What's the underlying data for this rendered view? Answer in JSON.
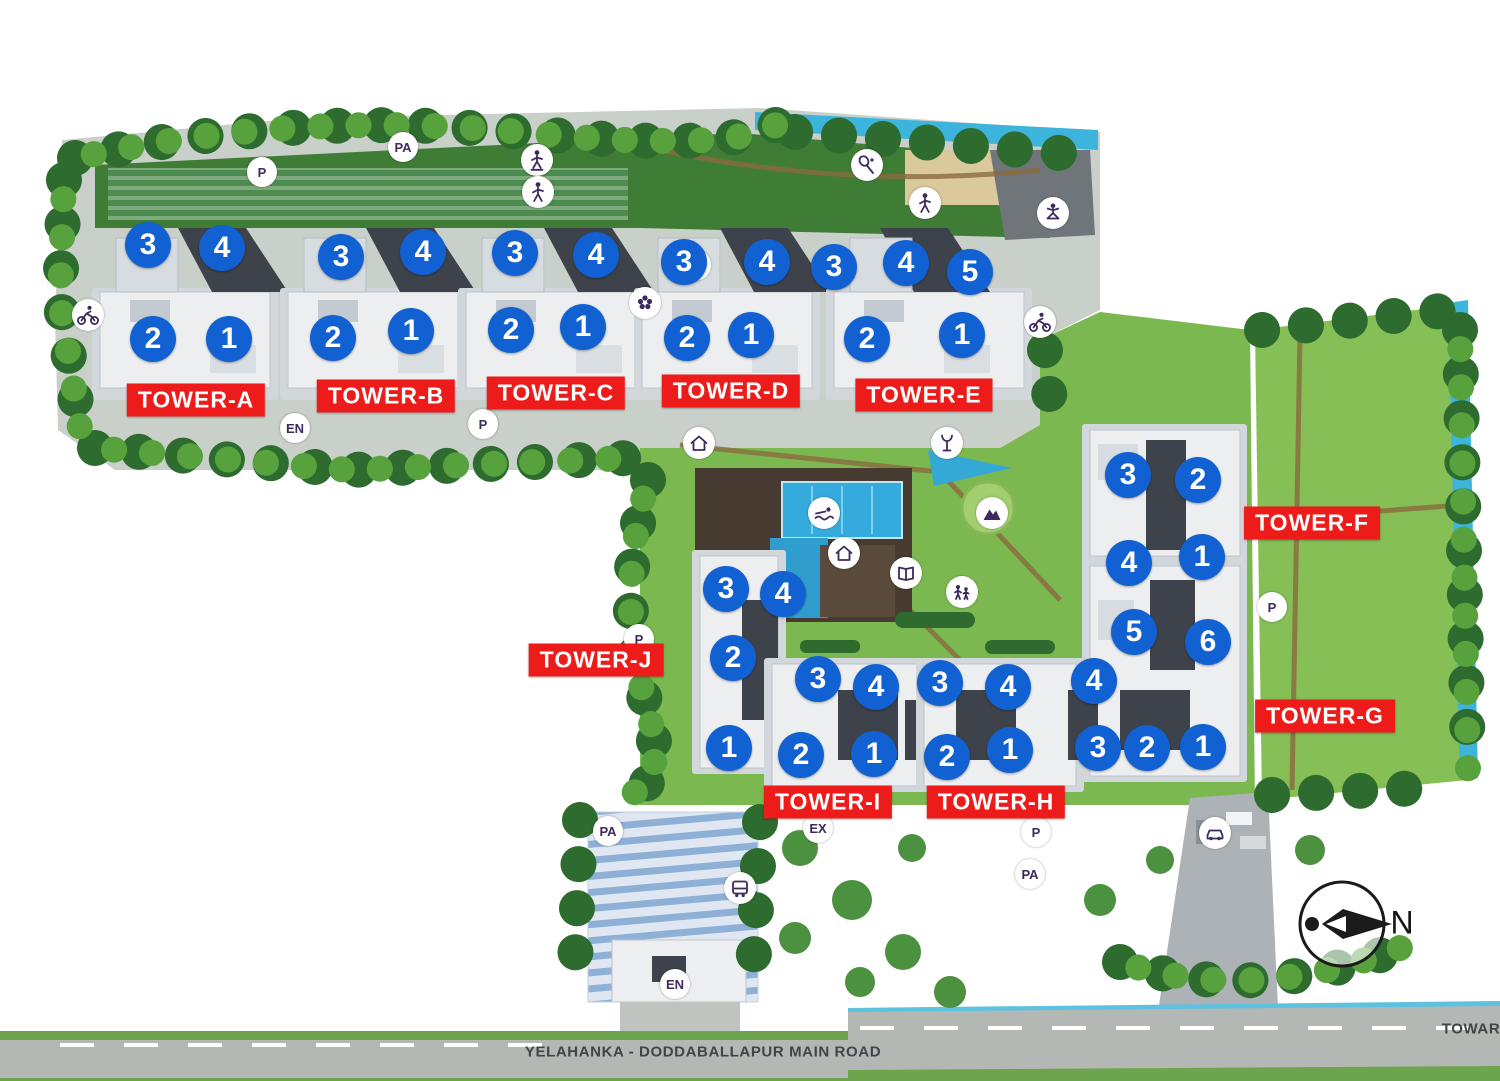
{
  "towers": [
    {
      "id": "A",
      "label": "TOWER-A",
      "label_pos": {
        "x": 196,
        "y": 400
      },
      "units": [
        {
          "n": "3",
          "x": 148,
          "y": 245
        },
        {
          "n": "4",
          "x": 222,
          "y": 248
        },
        {
          "n": "2",
          "x": 153,
          "y": 339
        },
        {
          "n": "1",
          "x": 229,
          "y": 339
        }
      ]
    },
    {
      "id": "B",
      "label": "TOWER-B",
      "label_pos": {
        "x": 386,
        "y": 396
      },
      "units": [
        {
          "n": "3",
          "x": 341,
          "y": 257
        },
        {
          "n": "4",
          "x": 423,
          "y": 252
        },
        {
          "n": "2",
          "x": 333,
          "y": 338
        },
        {
          "n": "1",
          "x": 411,
          "y": 331
        }
      ]
    },
    {
      "id": "C",
      "label": "TOWER-C",
      "label_pos": {
        "x": 556,
        "y": 393
      },
      "units": [
        {
          "n": "3",
          "x": 515,
          "y": 253
        },
        {
          "n": "4",
          "x": 596,
          "y": 255
        },
        {
          "n": "2",
          "x": 511,
          "y": 330
        },
        {
          "n": "1",
          "x": 583,
          "y": 327
        }
      ]
    },
    {
      "id": "D",
      "label": "TOWER-D",
      "label_pos": {
        "x": 731,
        "y": 391
      },
      "units": [
        {
          "n": "3",
          "x": 684,
          "y": 262
        },
        {
          "n": "4",
          "x": 767,
          "y": 262
        },
        {
          "n": "2",
          "x": 687,
          "y": 338
        },
        {
          "n": "1",
          "x": 751,
          "y": 335
        }
      ]
    },
    {
      "id": "E",
      "label": "TOWER-E",
      "label_pos": {
        "x": 924,
        "y": 395
      },
      "units": [
        {
          "n": "3",
          "x": 834,
          "y": 267
        },
        {
          "n": "4",
          "x": 906,
          "y": 263
        },
        {
          "n": "5",
          "x": 970,
          "y": 272
        },
        {
          "n": "2",
          "x": 867,
          "y": 339
        },
        {
          "n": "1",
          "x": 962,
          "y": 335
        }
      ]
    },
    {
      "id": "F",
      "label": "TOWER-F",
      "label_pos": {
        "x": 1312,
        "y": 523
      },
      "units": [
        {
          "n": "3",
          "x": 1128,
          "y": 475
        },
        {
          "n": "2",
          "x": 1198,
          "y": 480
        },
        {
          "n": "4",
          "x": 1129,
          "y": 563
        },
        {
          "n": "1",
          "x": 1202,
          "y": 557
        }
      ]
    },
    {
      "id": "G",
      "label": "TOWER-G",
      "label_pos": {
        "x": 1325,
        "y": 716
      },
      "units": [
        {
          "n": "5",
          "x": 1134,
          "y": 632
        },
        {
          "n": "6",
          "x": 1208,
          "y": 642
        },
        {
          "n": "4",
          "x": 1094,
          "y": 681
        },
        {
          "n": "3",
          "x": 1098,
          "y": 748
        },
        {
          "n": "2",
          "x": 1147,
          "y": 748
        },
        {
          "n": "1",
          "x": 1203,
          "y": 747
        }
      ]
    },
    {
      "id": "H",
      "label": "TOWER-H",
      "label_pos": {
        "x": 996,
        "y": 802
      },
      "units": [
        {
          "n": "3",
          "x": 940,
          "y": 683
        },
        {
          "n": "4",
          "x": 1008,
          "y": 687
        },
        {
          "n": "2",
          "x": 947,
          "y": 757
        },
        {
          "n": "1",
          "x": 1010,
          "y": 750
        }
      ]
    },
    {
      "id": "I",
      "label": "TOWER-I",
      "label_pos": {
        "x": 828,
        "y": 802
      },
      "units": [
        {
          "n": "3",
          "x": 818,
          "y": 679
        },
        {
          "n": "4",
          "x": 876,
          "y": 687
        },
        {
          "n": "2",
          "x": 801,
          "y": 755
        },
        {
          "n": "1",
          "x": 874,
          "y": 754
        }
      ]
    },
    {
      "id": "J",
      "label": "TOWER-J",
      "label_pos": {
        "x": 596,
        "y": 660
      },
      "units": [
        {
          "n": "3",
          "x": 726,
          "y": 589
        },
        {
          "n": "4",
          "x": 783,
          "y": 594
        },
        {
          "n": "2",
          "x": 733,
          "y": 658
        },
        {
          "n": "1",
          "x": 729,
          "y": 748
        }
      ]
    }
  ],
  "site_markers": [
    {
      "label": "P",
      "x": 262,
      "y": 172
    },
    {
      "label": "PA",
      "x": 403,
      "y": 147
    },
    {
      "label": "EN",
      "x": 295,
      "y": 428
    },
    {
      "label": "P",
      "x": 483,
      "y": 424
    },
    {
      "label": "P",
      "x": 639,
      "y": 639
    },
    {
      "label": "PA",
      "x": 608,
      "y": 831
    },
    {
      "label": "EX",
      "x": 818,
      "y": 828
    },
    {
      "label": "EN",
      "x": 675,
      "y": 984
    },
    {
      "label": "P",
      "x": 1036,
      "y": 832
    },
    {
      "label": "PA",
      "x": 1030,
      "y": 874
    },
    {
      "label": "P",
      "x": 1272,
      "y": 607
    }
  ],
  "amenity_icons": [
    {
      "name": "cyclist-icon",
      "x": 88,
      "y": 315
    },
    {
      "name": "skating-icon",
      "x": 537,
      "y": 160
    },
    {
      "name": "exercise-icon",
      "x": 538,
      "y": 192
    },
    {
      "name": "walking-icon",
      "x": 695,
      "y": 265
    },
    {
      "name": "spa-flower-icon",
      "x": 645,
      "y": 303
    },
    {
      "name": "racquet-court-icon",
      "x": 867,
      "y": 165
    },
    {
      "name": "jogging-icon",
      "x": 925,
      "y": 203
    },
    {
      "name": "yoga-icon",
      "x": 1053,
      "y": 213
    },
    {
      "name": "cyclist-icon-2",
      "x": 1040,
      "y": 322
    },
    {
      "name": "gazebo-icon",
      "x": 699,
      "y": 443
    },
    {
      "name": "fountain-icon",
      "x": 947,
      "y": 443
    },
    {
      "name": "swimming-pool-icon",
      "x": 824,
      "y": 513
    },
    {
      "name": "clubhouse-icon",
      "x": 844,
      "y": 553
    },
    {
      "name": "climbing-icon",
      "x": 992,
      "y": 513
    },
    {
      "name": "reading-icon",
      "x": 906,
      "y": 573
    },
    {
      "name": "kids-play-icon",
      "x": 962,
      "y": 592
    },
    {
      "name": "bus-stop-icon",
      "x": 740,
      "y": 888
    },
    {
      "name": "car-parking-icon",
      "x": 1215,
      "y": 833
    }
  ],
  "road": {
    "name": "YELAHANKA - DODDABALLAPUR MAIN ROAD",
    "right_edge_text": "TOWAR"
  },
  "compass": {
    "label": "N"
  },
  "colors": {
    "unit_marker_blue": "#1261d3",
    "tower_label_red": "#ee1b1b",
    "amenity_text_purple": "#3d2a5e",
    "water": "#3cb4dc",
    "lawn_green": "#7cb850"
  }
}
